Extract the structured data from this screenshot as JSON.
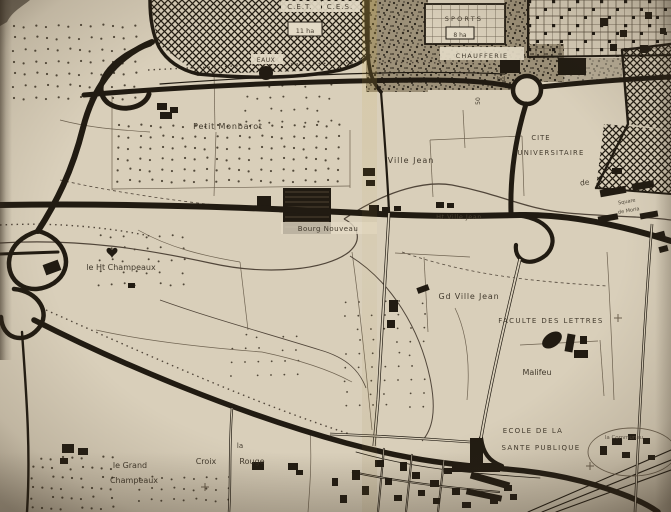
{
  "meta": {
    "description": "Scanned photograph of a 1960s French planning map of the Villejean district (Rennes)",
    "width": 671,
    "height": 512
  },
  "palette": {
    "paper": "#d9cfba",
    "paper_light": "#e3dac6",
    "ink": "#211b12",
    "ink_soft": "#6e6250",
    "ink_mid": "#51463a",
    "label": "#332b1f",
    "dot": "#3a3123"
  },
  "labels": [
    {
      "id": "cet",
      "text": "C.E.T.",
      "x": 300,
      "y": 9,
      "size": 7,
      "ls": 1,
      "chip": [
        281,
        1,
        40,
        11
      ]
    },
    {
      "id": "ces",
      "text": "C.E.S.",
      "x": 340,
      "y": 9,
      "size": 7,
      "ls": 1,
      "chip": [
        322,
        1,
        38,
        11
      ]
    },
    {
      "id": "11ha",
      "text": "11 ha",
      "x": 305,
      "y": 33,
      "size": 6.5,
      "chip": [
        288,
        22,
        34,
        14
      ],
      "box": true
    },
    {
      "id": "eaux",
      "text": "EAUX",
      "x": 266,
      "y": 62,
      "size": 6,
      "ls": 0.5,
      "chip": [
        251,
        54,
        32,
        10
      ]
    },
    {
      "id": "sports",
      "text": "SPORTS",
      "x": 464,
      "y": 21,
      "size": 6.5,
      "ls": 2.2
    },
    {
      "id": "8ha",
      "text": "8 ha",
      "x": 460,
      "y": 37,
      "size": 6,
      "chip": [
        446,
        27,
        28,
        12
      ],
      "box": true
    },
    {
      "id": "chaufferie",
      "text": "CHAUFFERIE",
      "x": 482,
      "y": 58,
      "size": 6.5,
      "ls": 1.2,
      "chip": [
        440,
        47,
        84,
        13
      ]
    },
    {
      "id": "bd",
      "text": "bd",
      "x": 501,
      "y": 81,
      "size": 6.5
    },
    {
      "id": "50",
      "text": "50",
      "x": 480,
      "y": 101,
      "size": 6,
      "rot": -90
    },
    {
      "id": "petit-monbarot",
      "text": "Petit Monbarot",
      "x": 228,
      "y": 129,
      "size": 8,
      "ls": 0.8
    },
    {
      "id": "ville-jean",
      "text": "Ville Jean",
      "x": 411,
      "y": 163,
      "size": 8,
      "ls": 1
    },
    {
      "id": "cite",
      "text": "CITE",
      "x": 541,
      "y": 140,
      "size": 6.8,
      "ls": 1
    },
    {
      "id": "universitaire",
      "text": "UNIVERSITAIRE",
      "x": 551,
      "y": 155,
      "size": 6.8,
      "ls": 1.2
    },
    {
      "id": "de",
      "text": "de",
      "x": 585,
      "y": 185,
      "size": 7.5,
      "rot": -8
    },
    {
      "id": "square",
      "text": "Square",
      "x": 627,
      "y": 203,
      "size": 5,
      "rot": -10,
      "color": "#3f382c"
    },
    {
      "id": "de-moria",
      "text": "de Moria",
      "x": 629,
      "y": 212,
      "size": 5,
      "rot": -10,
      "color": "#3f382c"
    },
    {
      "id": "bourg-nouveau",
      "text": "Bourg Nouveau",
      "x": 328,
      "y": 231,
      "size": 7,
      "ls": 0.5,
      "chip": [
        281,
        222,
        96,
        12
      ],
      "chip_op": 0.8
    },
    {
      "id": "ht-ville-jean",
      "text": "Ht Ville Jean",
      "x": 459,
      "y": 219,
      "size": 6.5,
      "ls": 0.5,
      "color": "#4e4536"
    },
    {
      "id": "ht-champeaux",
      "text": "le Ht Champeaux",
      "x": 121,
      "y": 270,
      "size": 8
    },
    {
      "id": "gd-ville-jean",
      "text": "Gd Ville Jean",
      "x": 469,
      "y": 299,
      "size": 8,
      "ls": 0.8
    },
    {
      "id": "faculte",
      "text": "FACULTE DES LETTRES",
      "x": 551,
      "y": 323,
      "size": 7,
      "ls": 1.4
    },
    {
      "id": "malifeu",
      "text": "Malifeu",
      "x": 537,
      "y": 375,
      "size": 8
    },
    {
      "id": "ecole-1",
      "text": "ECOLE DE LA",
      "x": 533,
      "y": 433,
      "size": 7,
      "ls": 1.3
    },
    {
      "id": "ecole-2",
      "text": "SANTE PUBLIQUE",
      "x": 541,
      "y": 450,
      "size": 7,
      "ls": 1.3
    },
    {
      "id": "communaute",
      "text": "la Communau",
      "x": 624,
      "y": 439,
      "size": 5.5,
      "color": "#5a5043"
    },
    {
      "id": "la",
      "text": "la",
      "x": 240,
      "y": 448,
      "size": 7
    },
    {
      "id": "croix",
      "text": "Croix",
      "x": 206,
      "y": 464,
      "size": 8
    },
    {
      "id": "rouge",
      "text": "Rouge",
      "x": 252,
      "y": 464,
      "size": 8
    },
    {
      "id": "le-grand",
      "text": "le Grand",
      "x": 130,
      "y": 468,
      "size": 8
    },
    {
      "id": "champeaux",
      "text": "Champeaux",
      "x": 134,
      "y": 483,
      "size": 8
    }
  ],
  "areas": [
    {
      "id": "cet-crosshatch",
      "pts": "150,0 368,0 368,56 340,70 198,74 158,44",
      "fill": "hatch"
    },
    {
      "id": "stipple-1",
      "rect": [
        366,
        0,
        62,
        92
      ],
      "fill": "stipple"
    },
    {
      "id": "stipple-2",
      "rect": [
        424,
        44,
        106,
        46
      ],
      "fill": "stipple"
    },
    {
      "id": "stipple-3",
      "rect": [
        504,
        0,
        26,
        46
      ],
      "fill": "stipple"
    },
    {
      "id": "stipple-4",
      "rect": [
        528,
        44,
        36,
        38
      ],
      "fill": "stipple"
    },
    {
      "id": "stipple-5",
      "rect": [
        560,
        58,
        62,
        24
      ],
      "fill": "stipple",
      "op": 0.55
    },
    {
      "id": "sports-gridzone",
      "rect": [
        528,
        0,
        143,
        57
      ],
      "fill": "griddot"
    },
    {
      "id": "sports-box",
      "rect": [
        425,
        4,
        80,
        40
      ],
      "fill": "paper",
      "stroke": 1.8
    },
    {
      "id": "sports-box-grid",
      "rect": [
        425,
        4,
        80,
        40
      ],
      "fill": "grid"
    },
    {
      "id": "hatch-east-1",
      "pts": "622,50 671,44 671,130 628,124",
      "fill": "hatch"
    },
    {
      "id": "hatch-east-2",
      "pts": "604,124 671,130 671,194 596,188",
      "fill": "hatch"
    }
  ],
  "roads": [
    {
      "id": "hatch-border-left",
      "d": "M 150,0 C 150,20 153,35 159,47 C 167,61 181,70 198,74",
      "w": 3.5
    },
    {
      "id": "hatch-border-bottom",
      "d": "M 198,74 C 252,79 302,78 340,70 C 355,66 363,62 368,56",
      "w": 3.5
    },
    {
      "id": "hatch-border-right",
      "d": "M 368,0 L 368,56",
      "w": 3.5
    },
    {
      "id": "top-boulevard-west",
      "d": "M 84,95 C 180,87 300,81 420,80 C 465,80 492,82 514,87",
      "w": 5
    },
    {
      "id": "top-boulevard-east",
      "d": "M 540,87 C 580,83 625,79 671,77",
      "w": 5
    },
    {
      "id": "top-boulevard-parallel",
      "d": "M 160,84 C 300,74 420,70 505,74",
      "w": 1.2
    },
    {
      "id": "roundabout",
      "circle": [
        527,
        90,
        14
      ],
      "w": 4.5
    },
    {
      "id": "ramp-horseshoe",
      "d": "M 150,44 C 108,58 90,88 108,103 C 124,114 146,106 149,94",
      "w": 5
    },
    {
      "id": "motorway-north",
      "d": "M 152,42 C 112,58 92,92 83,128 C 72,172 56,203 38,231",
      "w": 6
    },
    {
      "id": "cloverleaf-loop-a",
      "d": "M 38,231 C 66,238 76,268 54,283 C 32,297 8,285 9,262 C 10,246 22,236 38,231",
      "w": 4.5
    },
    {
      "id": "cloverleaf-loop-b",
      "d": "M 14,289 C 38,291 52,313 38,329 C 24,345 2,339 1,317",
      "w": 4.5
    },
    {
      "id": "exit-west",
      "d": "M 58,252 L 0,254",
      "w": 3
    },
    {
      "id": "motorway-south",
      "d": "M 22,332 C 26,390 31,450 27,512",
      "w": 2.4
    },
    {
      "id": "boulevard-diagonal",
      "d": "M 34,320 C 120,364 240,414 346,443 C 420,463 470,466 505,469 C 545,472 585,480 622,494 C 638,500 650,506 658,512",
      "w": 5.5
    },
    {
      "id": "main-road",
      "d": "M 0,205 C 140,203 260,208 360,213 C 430,217 480,216 520,215 C 575,214 630,228 671,241",
      "w": 6
    },
    {
      "id": "avenue-roundabout",
      "d": "M 526,104 C 515,140 510,175 511,213",
      "w": 5
    },
    {
      "id": "junction-loop",
      "d": "M 512,215 C 548,216 562,239 546,255 C 530,268 514,261 516,245",
      "w": 4.2
    },
    {
      "id": "junction-ecole",
      "d": "M 481,438 C 483,453 489,461 502,466",
      "w": 4.2
    },
    {
      "id": "road-cet-east",
      "d": "M 366,0 C 366,30 367,55 370,70 C 372,80 376,86 381,92",
      "w": 3.6
    },
    {
      "id": "road-villejean-north",
      "d": "M 381,92 C 384,130 387,170 389,211",
      "w": 2.2
    },
    {
      "id": "gridzone-border-bottom",
      "d": "M 528,57 L 671,55",
      "w": 2
    },
    {
      "id": "gridzone-border-left",
      "d": "M 528,0 L 528,57",
      "w": 2
    },
    {
      "id": "hatch-east-border",
      "d": "M 622,50 L 628,124 L 596,188",
      "w": 2.4
    },
    {
      "id": "hatch-east-border-top",
      "d": "M 622,50 L 671,44",
      "w": 2.4
    },
    {
      "id": "hatch-east-border-bottom",
      "d": "M 596,188 L 671,194",
      "w": 2
    },
    {
      "id": "rail-1",
      "d": "M 528,512 L 671,450",
      "w": 1.1
    },
    {
      "id": "rail-2",
      "d": "M 542,512 L 671,460",
      "w": 1.1
    },
    {
      "id": "rail-3",
      "d": "M 556,512 L 671,470",
      "w": 1.1
    },
    {
      "id": "boulevard-south-parallel",
      "d": "M 356,452 C 420,470 480,474 540,478",
      "w": 0.8
    }
  ],
  "casing_roads": [
    {
      "id": "villejean-south",
      "d": "M 389,213 C 386,270 381,340 378,400 C 376,422 375,434 374,446",
      "w": 3
    },
    {
      "id": "to-ecole",
      "d": "M 330,434 C 380,436 430,439 470,442",
      "w": 2.6
    },
    {
      "id": "croix-rouge",
      "d": "M 232,408 C 229,445 231,480 229,512",
      "w": 2.4
    },
    {
      "id": "east-vertical",
      "d": "M 652,224 C 646,300 640,400 635,512",
      "w": 2.6
    },
    {
      "id": "avenue-faculte",
      "d": "M 520,259 C 508,310 492,375 481,438",
      "w": 3.2
    },
    {
      "id": "urban-1",
      "d": "M 384,448 C 382,468 380,490 378,512",
      "w": 2
    },
    {
      "id": "urban-2",
      "d": "M 412,454 C 410,474 408,492 406,512",
      "w": 2
    },
    {
      "id": "urban-3",
      "d": "M 444,460 C 442,478 440,494 438,512",
      "w": 2
    },
    {
      "id": "urban-4",
      "d": "M 352,472 C 400,482 450,488 500,492",
      "w": 2
    }
  ],
  "thin_lines": [
    "M 112,96 L 112,190",
    "M 112,189 L 350,186",
    "M 350,130 L 350,188",
    "M 214,70 L 215,130",
    "M 216,132 L 214,196",
    "M 430,140 L 522,136",
    "M 430,140 L 433,197",
    "M 522,136 L 524,196",
    "M 463,110 L 465,148",
    "M 395,253 L 470,257",
    "M 424,257 L 428,332",
    "M 352,252 C 360,310 366,370 372,430",
    "M 455,308 C 468,335 470,368 467,400",
    "M 520,345 L 598,341",
    "M 600,340 L 604,396",
    "M 138,230 C 170,248 204,256 240,262",
    "M 240,262 L 248,330",
    "M 96,330 C 150,342 210,348 262,352",
    "M 310,430 C 312,460 310,485 308,512",
    "M 607,252 C 610,300 612,350 614,400",
    "M 60,120 C 90,128 120,130 150,132",
    "M 262,352 C 300,360 330,370 352,382"
  ],
  "curves": [
    {
      "d": "M 0,243 C 80,238 150,250 210,263 C 268,276 326,270 349,252 C 363,240 358,226 344,219",
      "w": 1.2
    },
    {
      "d": "M 344,219 C 390,188 428,181 452,185 C 504,195 524,209 568,213 C 612,217 642,216 671,220",
      "w": 1.3
    },
    {
      "d": "M 350,256 C 392,282 420,330 430,378 C 437,412 432,430 422,441",
      "w": 1
    },
    {
      "d": "M 60,180 C 140,198 220,206 300,214",
      "w": 0.8,
      "dash": "3,3"
    },
    {
      "d": "M 402,252 C 470,276 540,282 608,286",
      "w": 0.8,
      "dash": "3,3"
    },
    {
      "d": "M 160,300 C 210,318 262,332 320,350 C 348,358 360,372 366,388",
      "w": 0.8
    },
    {
      "d": "M 148,70 C 300,62 430,60 520,66",
      "w": 1.4,
      "dash": "1.5,4"
    },
    {
      "d": "M 46,310 C 150,356 260,406 356,436",
      "w": 1.4,
      "dash": "1.5,4"
    },
    {
      "d": "M 0,225 C 60,222 110,228 150,236",
      "w": 1.4,
      "dash": "1.5,4"
    }
  ],
  "dot_fields": [
    [
      14,
      14,
      128,
      90,
      11,
      12,
      1.1
    ],
    [
      118,
      126,
      228,
      66,
      11,
      11,
      1.1
    ],
    [
      246,
      86,
      88,
      38,
      12,
      12,
      1.0
    ],
    [
      100,
      236,
      94,
      60,
      12,
      12,
      1.0
    ],
    [
      346,
      302,
      86,
      116,
      13,
      13,
      0.9
    ],
    [
      32,
      458,
      84,
      52,
      10,
      10,
      1.1
    ],
    [
      140,
      478,
      94,
      32,
      11,
      11,
      1.0
    ],
    [
      232,
      336,
      66,
      48,
      13,
      13,
      0.9
    ]
  ],
  "buildings_under": [
    {
      "x": 283,
      "y": 188,
      "w": 48,
      "h": 46,
      "striped": true
    },
    {
      "x": 257,
      "y": 196,
      "w": 14,
      "h": 10
    }
  ],
  "buildings": [
    [
      157,
      103,
      10,
      7
    ],
    [
      170,
      107,
      8,
      6
    ],
    [
      160,
      112,
      12,
      7
    ],
    [
      363,
      168,
      12,
      8
    ],
    [
      366,
      180,
      9,
      6
    ],
    [
      369,
      205,
      10,
      7
    ],
    [
      382,
      207,
      8,
      6
    ],
    [
      394,
      206,
      7,
      5
    ],
    [
      436,
      202,
      8,
      6
    ],
    [
      447,
      203,
      7,
      5
    ],
    [
      500,
      60,
      20,
      13
    ],
    [
      558,
      58,
      28,
      17
    ],
    [
      600,
      188,
      26,
      7,
      -10
    ],
    [
      632,
      182,
      22,
      7,
      -10
    ],
    [
      598,
      215,
      20,
      6,
      -10
    ],
    [
      640,
      212,
      18,
      6,
      -10
    ],
    [
      612,
      168,
      10,
      6
    ],
    [
      566,
      334,
      8,
      18,
      10
    ],
    [
      574,
      350,
      14,
      8
    ],
    [
      580,
      336,
      7,
      8
    ],
    [
      389,
      300,
      9,
      12
    ],
    [
      387,
      320,
      8,
      8
    ],
    [
      417,
      286,
      12,
      6,
      -20
    ],
    [
      62,
      444,
      12,
      9
    ],
    [
      78,
      448,
      10,
      7
    ],
    [
      60,
      458,
      8,
      6
    ],
    [
      252,
      462,
      12,
      8
    ],
    [
      288,
      463,
      10,
      7
    ],
    [
      296,
      470,
      7,
      5
    ],
    [
      470,
      438,
      13,
      26
    ],
    [
      452,
      463,
      48,
      9
    ],
    [
      470,
      477,
      40,
      7,
      16
    ],
    [
      466,
      492,
      36,
      6,
      12
    ],
    [
      504,
      485,
      8,
      6
    ],
    [
      44,
      262,
      16,
      11,
      -20
    ],
    [
      600,
      18,
      8,
      8
    ],
    [
      620,
      30,
      7,
      7
    ],
    [
      645,
      12,
      7,
      7
    ],
    [
      660,
      28,
      6,
      6
    ],
    [
      610,
      44,
      7,
      7
    ],
    [
      640,
      45,
      8,
      8
    ],
    [
      352,
      470,
      8,
      10
    ],
    [
      362,
      486,
      7,
      9
    ],
    [
      375,
      460,
      9,
      7
    ],
    [
      385,
      478,
      7,
      7
    ],
    [
      394,
      495,
      8,
      6
    ],
    [
      400,
      462,
      7,
      9
    ],
    [
      412,
      472,
      8,
      7
    ],
    [
      418,
      490,
      7,
      6
    ],
    [
      430,
      480,
      9,
      7
    ],
    [
      433,
      498,
      7,
      6
    ],
    [
      444,
      468,
      8,
      6
    ],
    [
      452,
      488,
      8,
      7
    ],
    [
      462,
      502,
      9,
      6
    ],
    [
      490,
      498,
      8,
      6
    ],
    [
      510,
      494,
      7,
      6
    ],
    [
      340,
      495,
      7,
      8
    ],
    [
      332,
      478,
      6,
      8
    ],
    [
      612,
      438,
      10,
      7
    ],
    [
      628,
      434,
      8,
      6
    ],
    [
      643,
      438,
      7,
      6
    ],
    [
      622,
      452,
      8,
      6
    ],
    [
      648,
      455,
      7,
      5
    ],
    [
      600,
      446,
      7,
      9
    ],
    [
      655,
      232,
      10,
      6,
      -15
    ],
    [
      659,
      246,
      9,
      6,
      -15
    ],
    [
      128,
      283,
      7,
      5
    ]
  ],
  "symbols": {
    "crosses": [
      [
        205,
        487
      ],
      [
        590,
        466
      ],
      [
        618,
        318
      ]
    ],
    "eaux_dot": [
      266,
      73,
      7
    ],
    "heart": [
      112,
      250
    ],
    "malifeu_blob": [
      552,
      340,
      11,
      7,
      -35
    ],
    "communaute_ellipse": [
      632,
      452,
      44,
      24
    ]
  }
}
